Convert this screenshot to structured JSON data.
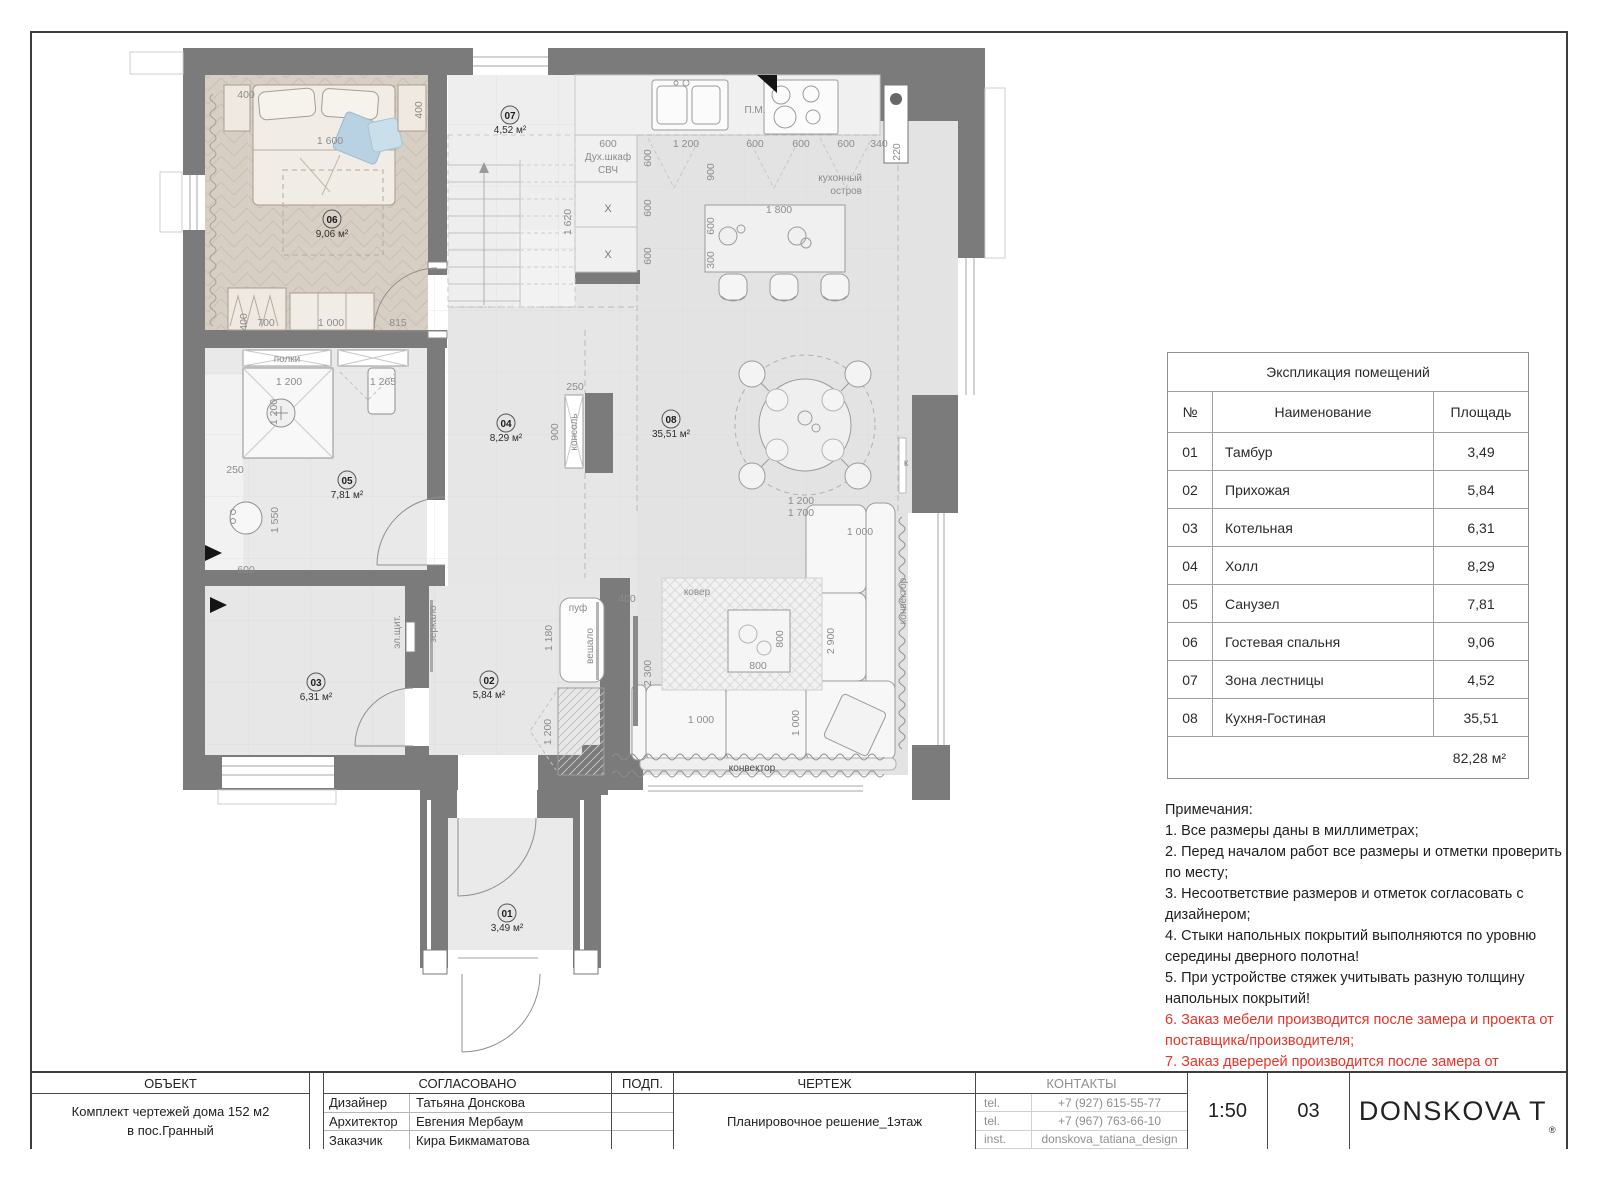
{
  "plan": {
    "rooms": [
      {
        "num": "01",
        "area": "3,49 м²"
      },
      {
        "num": "02",
        "area": "5,84 м²"
      },
      {
        "num": "03",
        "area": "6,31 м²"
      },
      {
        "num": "04",
        "area": "8,29 м²"
      },
      {
        "num": "05",
        "area": "7,81 м²"
      },
      {
        "num": "06",
        "area": "9,06 м²"
      },
      {
        "num": "07",
        "area": "4,52 м²"
      },
      {
        "num": "08",
        "area": "35,51 м²"
      }
    ],
    "dims": {
      "d220": "220",
      "d250": "250",
      "d300": "300",
      "d340": "340",
      "d400": "400",
      "d600": "600",
      "d700": "700",
      "d800": "800",
      "d815": "815",
      "d900": "900",
      "d1000": "1 000",
      "d1180": "1 180",
      "d1200": "1 200",
      "d1265": "1 265",
      "d1550": "1 550",
      "d1600": "1 600",
      "d1620": "1 620",
      "d1700": "1 700",
      "d1800": "1 800",
      "d2300": "2 300",
      "d2900": "2 900"
    },
    "labels": {
      "pm": "П.М.",
      "ovens1": "Дух.шкаф",
      "ovens2": "СВЧ",
      "x": "X",
      "island1": "кухонный",
      "island2": "остров",
      "console": "консоль",
      "shelves": "полки",
      "elpanel": "эл.щит.",
      "mirror": "зеркало",
      "pouf": "пуф",
      "rack": "вешало",
      "carpet": "ковер",
      "convector": "конвектор",
      "k": "к"
    }
  },
  "table": {
    "title": "Экспликация помещений",
    "headers": {
      "num": "№",
      "name": "Наименование",
      "area": "Площадь"
    },
    "rows": [
      {
        "num": "01",
        "name": "Тамбур",
        "area": "3,49"
      },
      {
        "num": "02",
        "name": "Прихожая",
        "area": "5,84"
      },
      {
        "num": "03",
        "name": "Котельная",
        "area": "6,31"
      },
      {
        "num": "04",
        "name": "Холл",
        "area": "8,29"
      },
      {
        "num": "05",
        "name": "Санузел",
        "area": "7,81"
      },
      {
        "num": "06",
        "name": "Гостевая спальня",
        "area": "9,06"
      },
      {
        "num": "07",
        "name": "Зона лестницы",
        "area": "4,52"
      },
      {
        "num": "08",
        "name": "Кухня-Гостиная",
        "area": "35,51"
      }
    ],
    "total": "82,28 м²"
  },
  "notes": {
    "title": "Примечания:",
    "items": [
      {
        "text": "1. Все размеры даны в миллиметрах;",
        "red": false
      },
      {
        "text": "2. Перед началом работ все размеры и отметки проверить по месту;",
        "red": false
      },
      {
        "text": "3. Несоответствие размеров и отметок согласовать с дизайнером;",
        "red": false
      },
      {
        "text": "4. Стыки напольных покрытий выполняются по уровню середины дверного полотна!",
        "red": false
      },
      {
        "text": "5. При устройстве стяжек учитывать разную толщину напольных покрытий!",
        "red": false
      },
      {
        "text": "6. Заказ мебели производится после замера и проекта от поставщика/производителя;",
        "red": true
      },
      {
        "text": "7. Заказ дверерей производится после замера от поставщика.",
        "red": true
      }
    ]
  },
  "titleblock": {
    "object_label": "ОБЪЕКТ",
    "object_line1": "Комплект чертежей дома 152 м2",
    "object_line2": "в пос.Гранный",
    "approved_label": "СОГЛАСОВАНО",
    "roles": [
      {
        "role": "Дизайнер",
        "name": "Татьяна Донскова"
      },
      {
        "role": "Архитектор",
        "name": "Евгения Мербаум"
      },
      {
        "role": "Заказчик",
        "name": "Кира Бикмаматова"
      }
    ],
    "sign_label": "ПОДП.",
    "drawing_label": "ЧЕРТЕЖ",
    "drawing_name": "Планировочное решение_1этаж",
    "contacts_label": "КОНТАКТЫ",
    "contacts": [
      {
        "type": "tel.",
        "value": "+7 (927) 615-55-77"
      },
      {
        "type": "tel.",
        "value": "+7 (967) 763-66-10"
      },
      {
        "type": "inst.",
        "value": "donskova_tatiana_design"
      }
    ],
    "scale": "1:50",
    "sheet_number": "03",
    "brand": "DONSKOVA T",
    "brand_mark": "®"
  }
}
